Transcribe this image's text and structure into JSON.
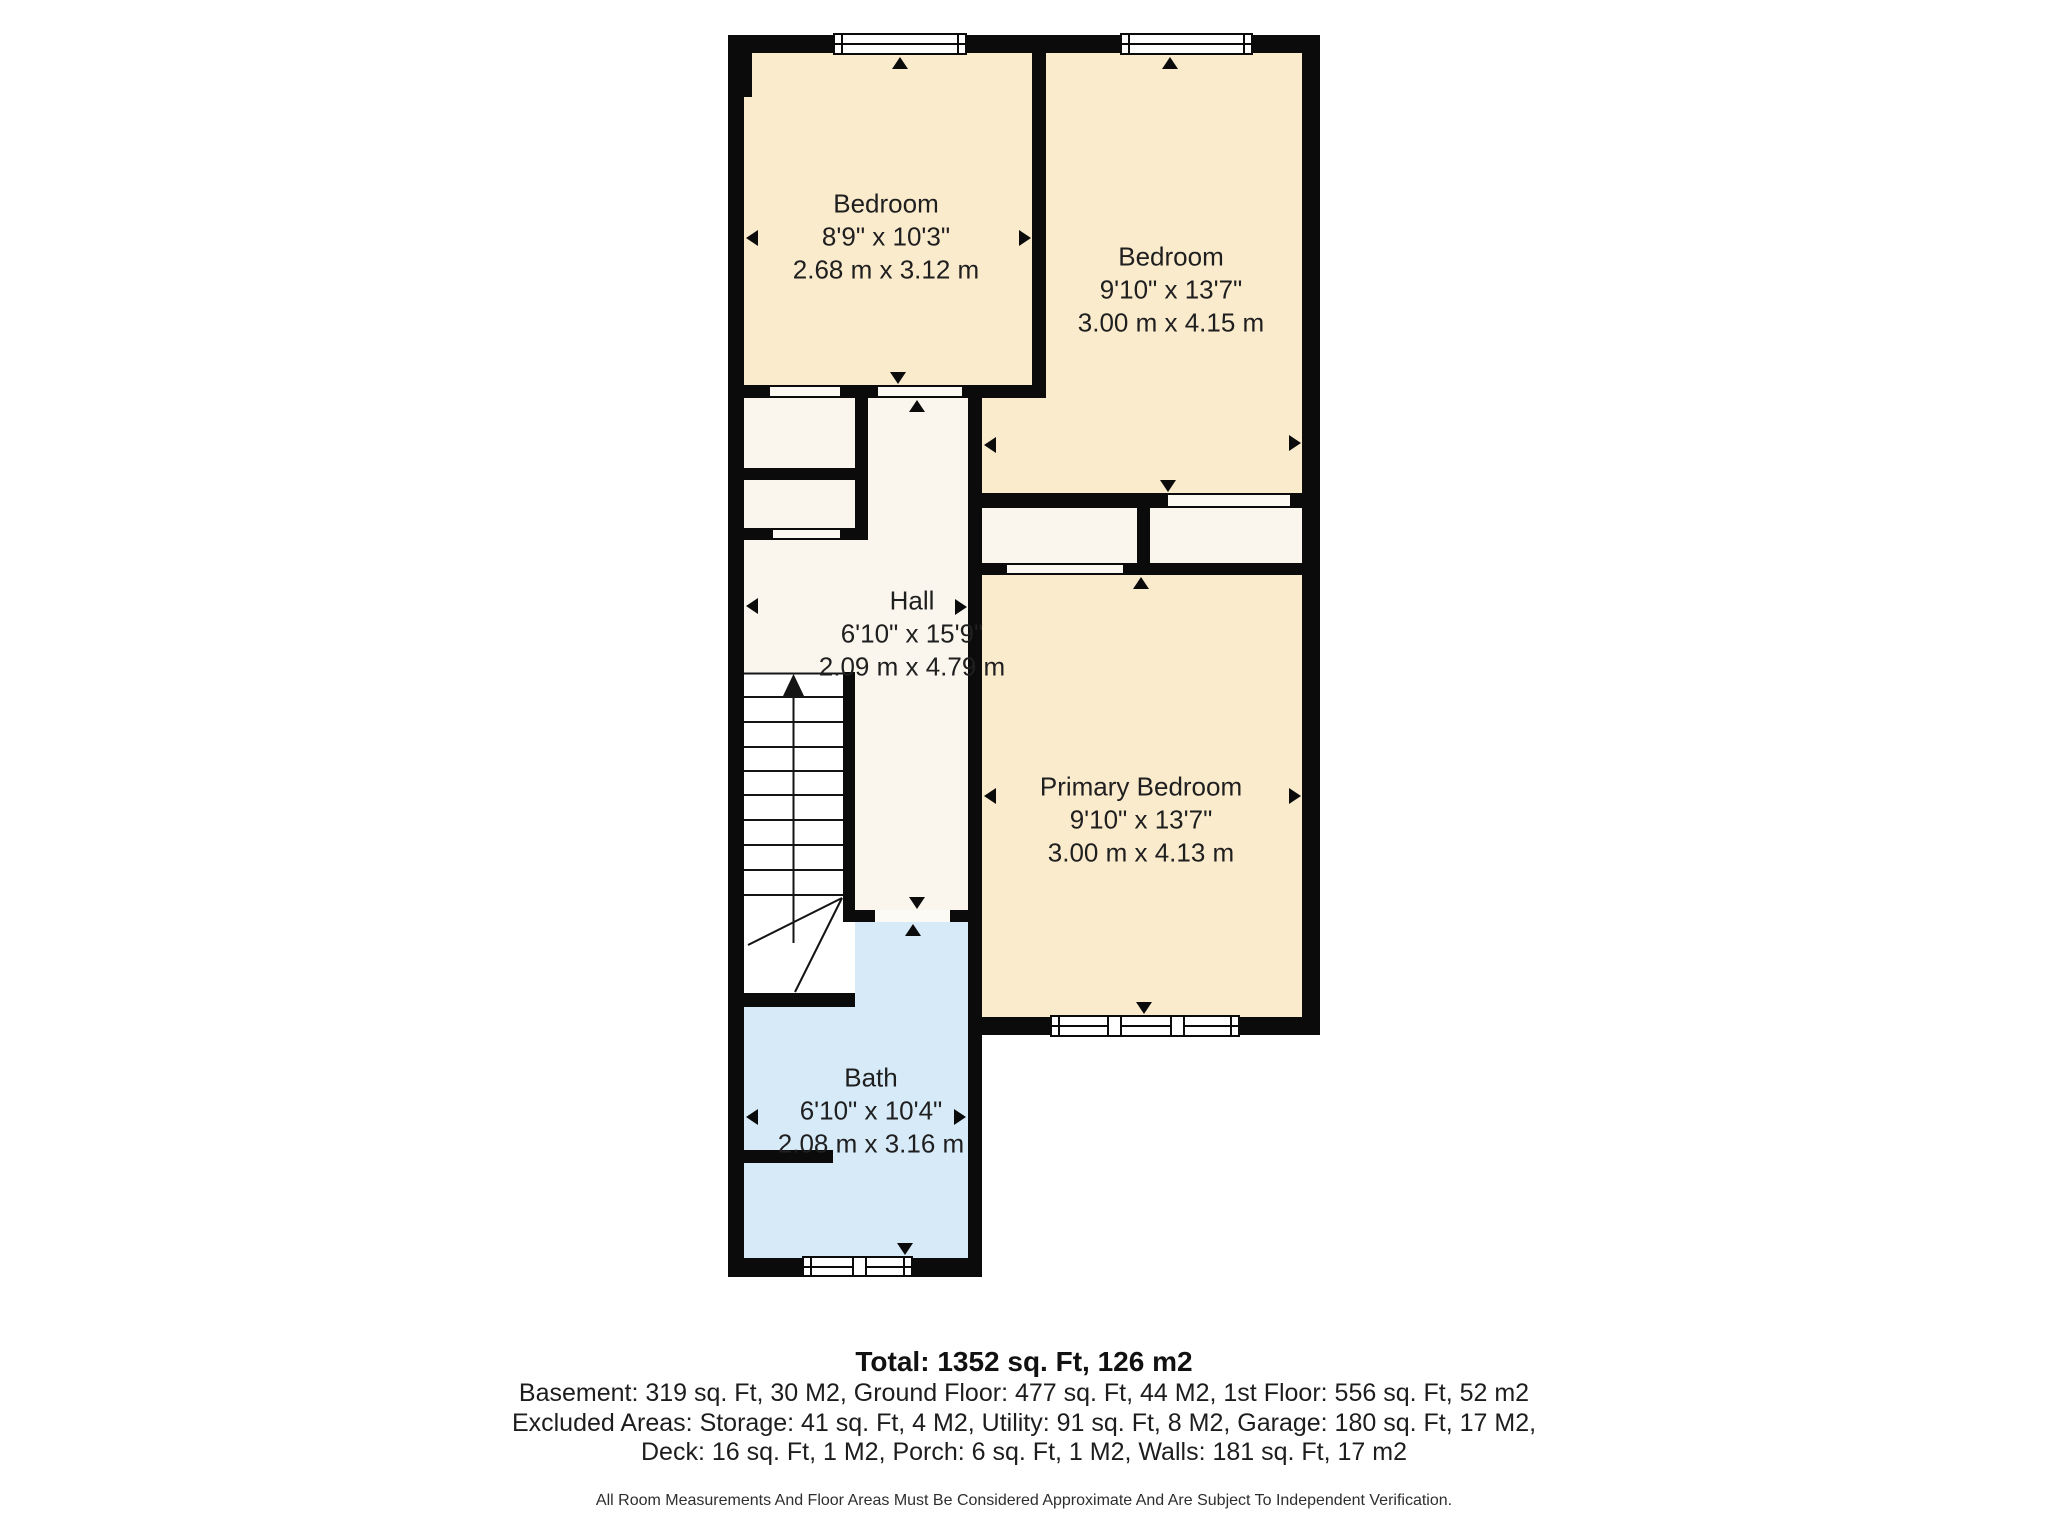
{
  "plan": {
    "rooms": [
      {
        "name": "Bedroom",
        "imperial": "8'9\" x 10'3\"",
        "metric": "2.68 m x 3.12 m"
      },
      {
        "name": "Bedroom",
        "imperial": "9'10\" x 13'7\"",
        "metric": "3.00 m x 4.15 m"
      },
      {
        "name": "Hall",
        "imperial": "6'10\" x 15'9\"",
        "metric": "2.09 m x 4.79 m"
      },
      {
        "name": "Primary Bedroom",
        "imperial": "9'10\" x 13'7\"",
        "metric": "3.00 m x 4.13 m"
      },
      {
        "name": "Bath",
        "imperial": "6'10\" x 10'4\"",
        "metric": "2.08 m x 3.16 m"
      }
    ]
  },
  "summary": {
    "total": "Total: 1352 sq. Ft, 126 m2",
    "line1": "Basement: 319 sq. Ft, 30 M2, Ground Floor: 477 sq. Ft, 44 M2, 1st Floor: 556 sq. Ft, 52 m2",
    "line2": "Excluded Areas: Storage: 41 sq. Ft, 4 M2, Utility: 91 sq. Ft, 8 M2, Garage: 180 sq. Ft, 17 M2,",
    "line3": "Deck: 16 sq. Ft, 1 M2, Porch: 6 sq. Ft, 1 M2, Walls: 181 sq. Ft, 17 m2",
    "disclaimer": "All Room Measurements And Floor Areas Must Be Considered Approximate And Are Subject To Independent Verification."
  },
  "colors": {
    "wall": "#0b0b0b",
    "room-cream": "#faebcd",
    "room-offwhite": "#faf6ed",
    "room-white": "#ffffff",
    "room-blue": "#d6eaf8",
    "text": "#1f1f1f",
    "page-bg": "#ffffff"
  }
}
